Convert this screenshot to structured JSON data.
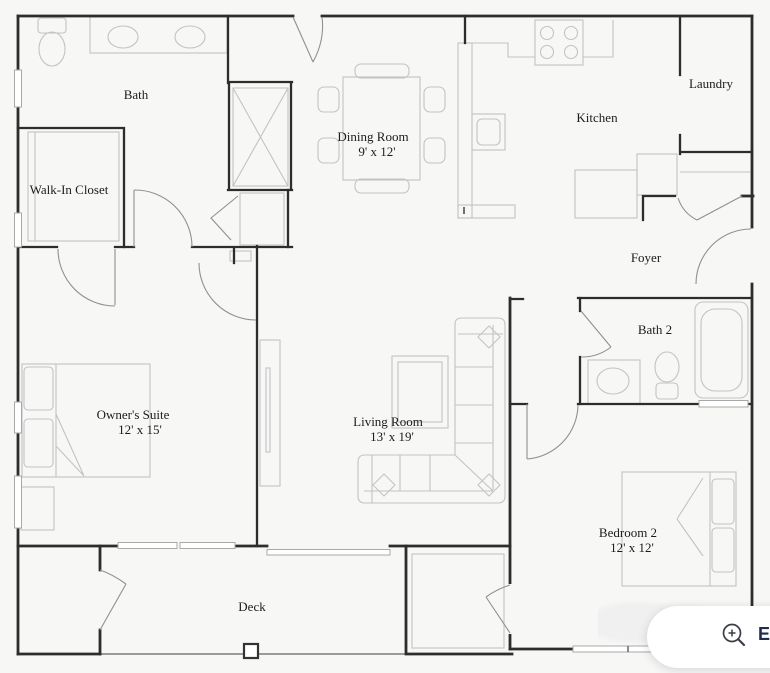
{
  "floor_plan": {
    "rooms": [
      {
        "id": "bath",
        "label": "Bath",
        "dims": ""
      },
      {
        "id": "walk_in_closet",
        "label": "Walk-In Closet",
        "dims": ""
      },
      {
        "id": "dining_room",
        "label": "Dining Room",
        "dims": "9' x 12'"
      },
      {
        "id": "kitchen",
        "label": "Kitchen",
        "dims": ""
      },
      {
        "id": "laundry",
        "label": "Laundry",
        "dims": ""
      },
      {
        "id": "foyer",
        "label": "Foyer",
        "dims": ""
      },
      {
        "id": "bath2",
        "label": "Bath 2",
        "dims": ""
      },
      {
        "id": "owners_suite",
        "label": "Owner's Suite",
        "dims": "12' x 15'"
      },
      {
        "id": "living_room",
        "label": "Living Room",
        "dims": "13' x 19'"
      },
      {
        "id": "bedroom2",
        "label": "Bedroom 2",
        "dims": "12' x 12'"
      },
      {
        "id": "deck",
        "label": "Deck",
        "dims": ""
      }
    ]
  },
  "controls": {
    "expand_button": {
      "icon": "zoom-in-icon",
      "label": "E"
    }
  },
  "colors": {
    "background": "#f7f7f6",
    "wall": "#2d2d2d",
    "fixture": "#c3c3c4",
    "door": "#909090",
    "button_text": "#1f2d4e"
  }
}
